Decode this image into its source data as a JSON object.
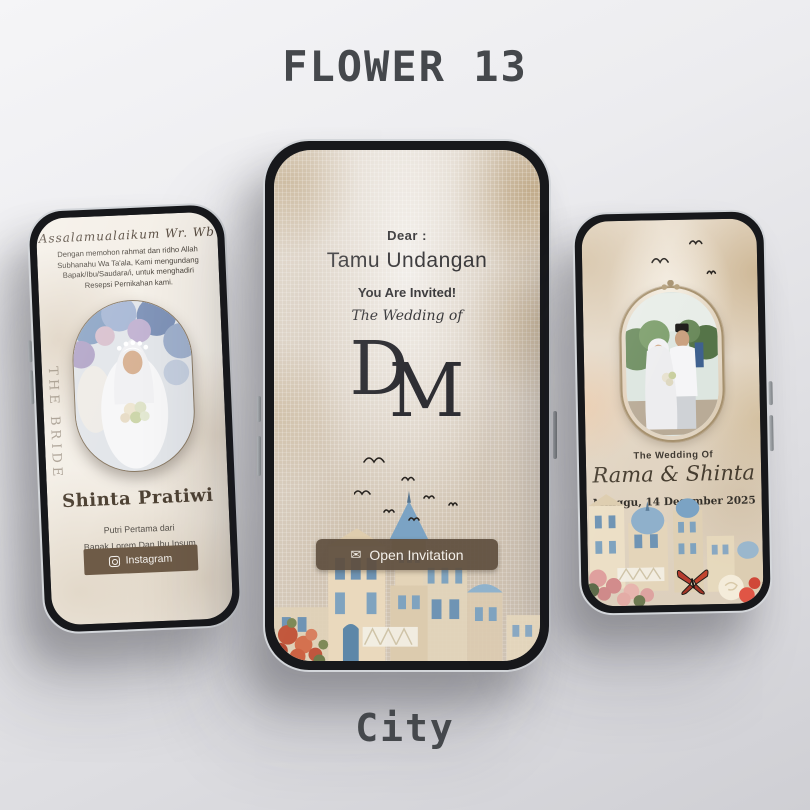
{
  "page": {
    "title": "FLOWER 13",
    "subtitle": "City"
  },
  "left_phone": {
    "greeting": "Assalamualaikum Wr. Wb",
    "intro": "Dengan memohon rahmat dan ridho Allah Subhanahu Wa Ta'ala, Kami mengundang Bapak/Ibu/Saudara/i, untuk menghadiri Resepsi Pernikahan kami.",
    "side_label": "THE BRIDE",
    "bride_name": "Shinta Pratiwi",
    "parent_line1": "Putri Pertama dari",
    "parent_line2": "Bapak Lorem Dan Ibu Ipsum",
    "instagram_label": "Instagram"
  },
  "center_phone": {
    "dear": "Dear :",
    "guest_name": "Tamu Undangan",
    "invited": "You Are Invited!",
    "wedding_of": "The Wedding of",
    "monogram_d": "D",
    "monogram_m": "M",
    "open_button_label": "Open Invitation",
    "envelope_glyph": "✉"
  },
  "right_phone": {
    "wedding_of": "The Wedding Of",
    "couple_names": "Rama & Shinta",
    "date": "Minggu, 14 Desember 2025"
  },
  "icons": {
    "instagram": "instagram-icon",
    "envelope": "envelope-icon"
  },
  "colors": {
    "accent_brown": "#6e5b47",
    "button_brown": "#5f4f3e",
    "title_gray": "#45484c",
    "screen_cream": "#f4efe7",
    "screen_beige": "#d8cec1",
    "roof_blue": "#7ba3c4"
  }
}
